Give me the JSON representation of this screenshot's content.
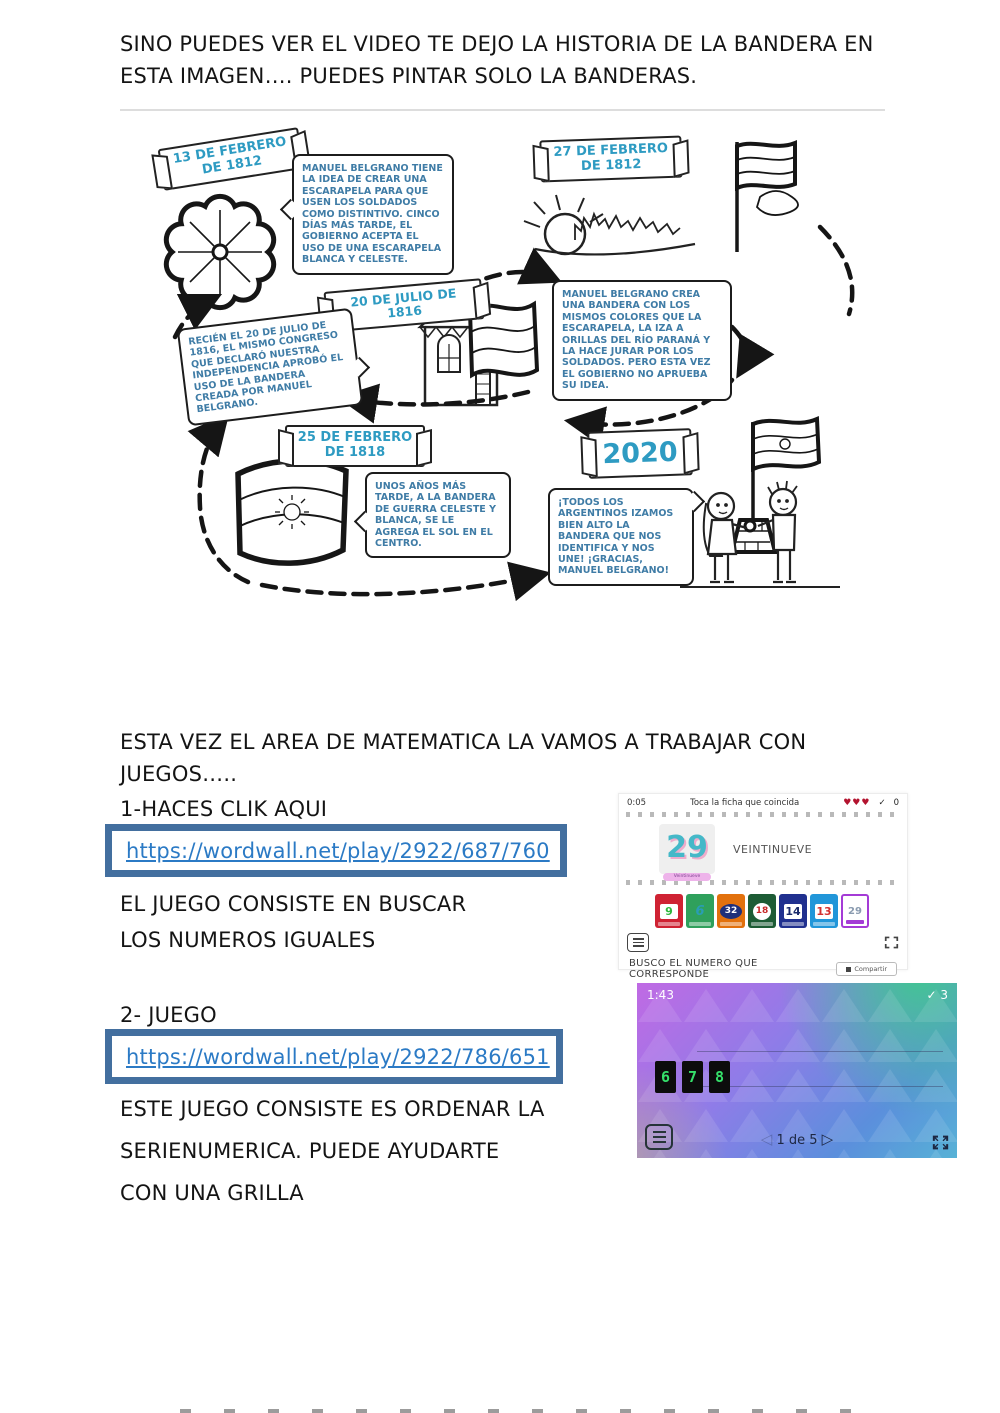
{
  "header": {
    "intro": "SINO PUEDES VER EL VIDEO TE DEJO LA HISTORIA DE LA BANDERA EN ESTA IMAGEN…. PUEDES PINTAR SOLO LA BANDERAS."
  },
  "timeline": {
    "banners": [
      {
        "label": "13 DE FEBRERO DE 1812"
      },
      {
        "label": "27 DE FEBRERO DE 1812"
      },
      {
        "label": "20 DE JULIO DE 1816"
      },
      {
        "label": "25 DE FEBRERO DE 1818"
      },
      {
        "label": "2020"
      }
    ],
    "notes": [
      {
        "text": "MANUEL BELGRANO TIENE LA IDEA DE CREAR UNA ESCARAPELA PARA QUE USEN LOS SOLDADOS COMO DISTINTIVO. CINCO DÍAS MÁS TARDE, EL GOBIERNO ACEPTA EL USO DE UNA ESCARAPELA BLANCA Y CELESTE."
      },
      {
        "text": "MANUEL BELGRANO CREA UNA BANDERA CON LOS MISMOS COLORES QUE LA ESCARAPELA, LA IZA A ORILLAS DEL RÍO PARANÁ Y LA HACE JURAR POR LOS SOLDADOS. PERO ESTA VEZ EL GOBIERNO NO APRUEBA SU IDEA."
      },
      {
        "text": "RECIÉN EL 20 DE JULIO DE 1816, EL MISMO CONGRESO QUE DECLARÓ NUESTRA INDEPENDENCIA APROBÓ EL USO DE LA BANDERA CREADA POR MANUEL BELGRANO."
      },
      {
        "text": "UNOS AÑOS MÁS TARDE, A LA BANDERA DE GUERRA CELESTE Y BLANCA, SE LE AGREGA EL SOL EN EL CENTRO."
      },
      {
        "text": "¡TODOS LOS ARGENTINOS IZAMOS BIEN ALTO LA BANDERA QUE NOS IDENTIFICA Y NOS UNE! ¡GRACIAS, MANUEL BELGRANO!"
      }
    ]
  },
  "math_section": {
    "intro": "ESTA VEZ EL AREA DE MATEMATICA LA VAMOS A TRABAJAR CON JUEGOS…..",
    "step1_label": "1-HACES CLIK AQUI",
    "link1": "https://wordwall.net/play/2922/687/760",
    "desc1": "EL JUEGO CONSISTE EN BUSCAR LOS NUMEROS IGUALES",
    "step2_label": "2- JUEGO",
    "link2": "https://wordwall.net/play/2922/786/651",
    "desc2_line1": "ESTE JUEGO CONSISTE ES ORDENAR LA",
    "desc2_line2": "SERIENUMERICA. PUEDE AYUDARTE",
    "desc2_line3": "CON UNA GRILLA"
  },
  "game1": {
    "timer": "0:05",
    "title": "Toca la ficha que coincida",
    "hearts": "♥♥♥",
    "check": "✓",
    "score": "0",
    "card_number": "29",
    "card_label": "Veintinueve",
    "card_word": "VEINTINUEVE",
    "tiles": [
      {
        "number": "9",
        "bg": "#cf2233"
      },
      {
        "number": "6",
        "bg": "#2fa05c"
      },
      {
        "number": "32",
        "bg": "#e2710d"
      },
      {
        "number": "18",
        "bg": "#1d5c35"
      },
      {
        "number": "14",
        "bg": "#20308f"
      },
      {
        "number": "13",
        "bg": "#2196d9"
      },
      {
        "number": "29",
        "bg": "#ffffff"
      }
    ],
    "caption": "BUSCO EL NUMERO QUE CORRESPONDE",
    "share_button": "Compartir",
    "footer_links": [
      {
        "label": "Editar contenido…"
      },
      {
        "label": "Incrustar"
      },
      {
        "label": "Más"
      }
    ]
  },
  "game2": {
    "timer": "1:43",
    "check": "✓",
    "score": "3",
    "tiles": [
      {
        "number": "6"
      },
      {
        "number": "7"
      },
      {
        "number": "8"
      }
    ],
    "pagination": "1 de 5"
  },
  "colors": {
    "link_blue": "#2b7ac5",
    "link_box_border": "#436f9f",
    "date_blue": "#2e9bc2",
    "note_blue": "#3f7ca6",
    "game2_digit_green": "#35e06a"
  }
}
